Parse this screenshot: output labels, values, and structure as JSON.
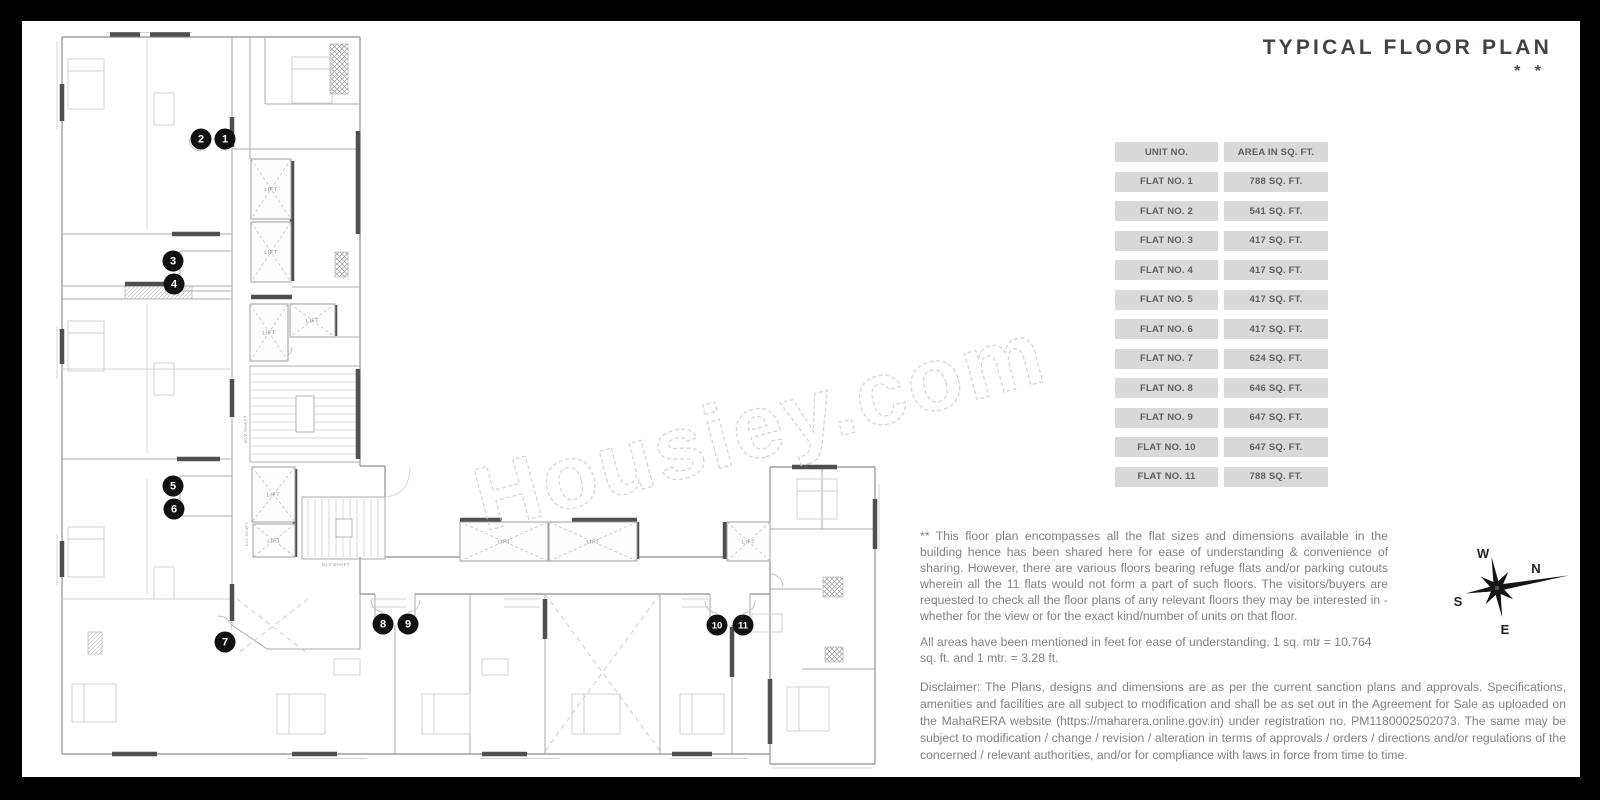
{
  "title": {
    "text": "TYPICAL FLOOR PLAN",
    "asterisks": "* *"
  },
  "watermark": "Housiey.com",
  "table": {
    "headers": [
      "UNIT NO.",
      "AREA IN SQ. FT."
    ],
    "rows": [
      [
        "FLAT NO. 1",
        "788 SQ. FT."
      ],
      [
        "FLAT NO. 2",
        "541 SQ. FT."
      ],
      [
        "FLAT NO. 3",
        "417 SQ. FT."
      ],
      [
        "FLAT NO. 4",
        "417 SQ. FT."
      ],
      [
        "FLAT NO. 5",
        "417 SQ. FT."
      ],
      [
        "FLAT NO. 6",
        "417 SQ. FT."
      ],
      [
        "FLAT NO. 7",
        "624 SQ. FT."
      ],
      [
        "FLAT NO. 8",
        "646 SQ. FT."
      ],
      [
        "FLAT NO. 9",
        "647 SQ. FT."
      ],
      [
        "FLAT NO. 10",
        "647 SQ. FT."
      ],
      [
        "FLAT NO. 11",
        "788 SQ. FT."
      ]
    ]
  },
  "notes": {
    "note1": "** This floor plan encompasses all the flat sizes and dimensions available in the building hence has been shared here for ease of understanding & convenience of sharing. However, there are various floors bearing refuge flats and/or parking cutouts wherein all the 11 flats would not form a part of such floors. The visitors/buyers are requested to check all the floor plans of any relevant floors they may be interested in - whether for the view or for the exact kind/number of units on that floor.",
    "note2": "All areas have been mentioned in feet for ease of understanding. 1 sq. mtr = 10.764 sq. ft. and 1 mtr. = 3.28 ft.",
    "disclaimer": "Disclaimer: The Plans, designs and dimensions are as per the current sanction plans and approvals. Specifications, amenities and facilities are all subject to modification and shall be as set out in the Agreement for Sale as uploaded on the MahaRERA website (https://maharera.online.gov.in) under registration no. PM1180002502073. The same may be subject to modification / change / revision / alteration in terms of approvals / orders / directions and/or regulations of the concerned / relevant authorities, and/or for compliance with laws in force from time to time."
  },
  "compass": {
    "n": "N",
    "s": "S",
    "e": "E",
    "w": "W"
  },
  "colors": {
    "background": "#000000",
    "panel": "#ffffff",
    "table_cell": "#d9d9d9",
    "marker": "#111111",
    "dark_wall": "#4f4f4f"
  },
  "plan": {
    "lift_label": "LIFT",
    "shaft_label": "ELV SHAFT",
    "shaft_labels_pos": [
      {
        "x": 195,
        "y": 400,
        "rot": -90,
        "fs": 4.5
      },
      {
        "x": 196,
        "y": 505,
        "rot": -90,
        "fs": 3.8
      },
      {
        "x": 284,
        "y": 537,
        "rot": 0,
        "fs": 4.5
      }
    ],
    "lifts": [
      {
        "x": 199,
        "y": 130,
        "w": 40,
        "h": 60
      },
      {
        "x": 199,
        "y": 193,
        "w": 40,
        "h": 60
      },
      {
        "x": 198,
        "y": 275,
        "w": 38,
        "h": 57
      },
      {
        "x": 238,
        "y": 275,
        "w": 45,
        "h": 33
      },
      {
        "x": 200,
        "y": 438,
        "w": 43,
        "h": 55
      },
      {
        "x": 201,
        "y": 495,
        "w": 42,
        "h": 33
      },
      {
        "x": 408,
        "y": 493,
        "w": 88,
        "h": 39
      },
      {
        "x": 497,
        "y": 493,
        "w": 88,
        "h": 39
      },
      {
        "x": 675,
        "y": 493,
        "w": 43,
        "h": 39
      }
    ],
    "markers": [
      {
        "n": "1",
        "x": 173,
        "y": 110
      },
      {
        "n": "2",
        "x": 149,
        "y": 110
      },
      {
        "n": "3",
        "x": 121,
        "y": 232
      },
      {
        "n": "4",
        "x": 122,
        "y": 255
      },
      {
        "n": "5",
        "x": 121,
        "y": 457
      },
      {
        "n": "6",
        "x": 122,
        "y": 480
      },
      {
        "n": "7",
        "x": 173,
        "y": 613
      },
      {
        "n": "8",
        "x": 331,
        "y": 595
      },
      {
        "n": "9",
        "x": 356,
        "y": 595
      },
      {
        "n": "10",
        "x": 665,
        "y": 596
      },
      {
        "n": "11",
        "x": 691,
        "y": 596
      }
    ]
  }
}
